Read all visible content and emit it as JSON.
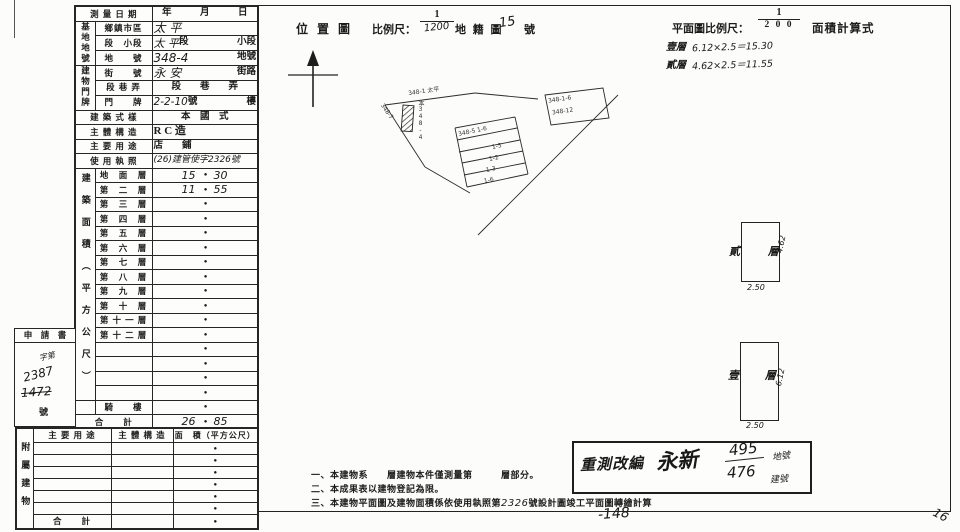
{
  "sheet": {
    "decimal_dot": "●"
  },
  "main_table": {
    "group_site": "基地地號",
    "group_door": "建物門牌",
    "group_area": "建築面積（平方公尺）",
    "survey_date": {
      "label": "測 量 日 期",
      "value": "年　　　月　　　日"
    },
    "district": {
      "label": "鄉鎮市區",
      "hw": "太 平"
    },
    "section": {
      "label": "段　小段",
      "hw": "太 平",
      "mid": "段",
      "suffix": "小段"
    },
    "lot": {
      "label": "地　　號",
      "hw": "348-4",
      "suffix": "地號"
    },
    "street": {
      "label": "街　　號",
      "hw": "永 安",
      "suffix": "街路"
    },
    "lane": {
      "label": "段 巷 弄",
      "value": "段　　巷　　弄"
    },
    "door": {
      "label": "門　　牌",
      "hw": "2-2-10",
      "mid": "號",
      "suffix": "樓"
    },
    "style": {
      "label": "建 築 式 樣",
      "value": "本　國　式"
    },
    "structure": {
      "label": "主 體 構 造",
      "value": "R C 造"
    },
    "usage": {
      "label": "主 要 用 途",
      "value": "店　　鋪"
    },
    "license": {
      "label": "使 用 執 照",
      "hw": "(26)建管使字2326號"
    },
    "floors": [
      {
        "label": "地　面　層",
        "int": "15",
        "dec": "30"
      },
      {
        "label": "第　二　層",
        "int": "11",
        "dec": "55"
      },
      {
        "label": "第　三　層",
        "int": "",
        "dec": ""
      },
      {
        "label": "第　四　層",
        "int": "",
        "dec": ""
      },
      {
        "label": "第　五　層",
        "int": "",
        "dec": ""
      },
      {
        "label": "第　六　層",
        "int": "",
        "dec": ""
      },
      {
        "label": "第　七　層",
        "int": "",
        "dec": ""
      },
      {
        "label": "第　八　層",
        "int": "",
        "dec": ""
      },
      {
        "label": "第　九　層",
        "int": "",
        "dec": ""
      },
      {
        "label": "第　十　層",
        "int": "",
        "dec": ""
      },
      {
        "label": "第 十 一 層",
        "int": "",
        "dec": ""
      },
      {
        "label": "第 十 二 層",
        "int": "",
        "dec": ""
      },
      {
        "label": "",
        "int": "",
        "dec": ""
      },
      {
        "label": "",
        "int": "",
        "dec": ""
      },
      {
        "label": "",
        "int": "",
        "dec": ""
      },
      {
        "label": "",
        "int": "",
        "dec": ""
      },
      {
        "label": "騎　　樓",
        "int": "",
        "dec": ""
      }
    ],
    "total": {
      "label": "合　　計",
      "int": "26",
      "dec": "85"
    }
  },
  "applicant_box": {
    "title": "申　請　書",
    "line1": "字第",
    "line2": "2387",
    "line3": "1472",
    "suffix": "號"
  },
  "annex_table": {
    "side": "附屬建物",
    "h1": "主 要 用 途",
    "h2": "主 體 構 造",
    "h3": "面　積（平方公尺）",
    "total": "合　　計"
  },
  "location_map": {
    "title": "位 置 圖",
    "scale_label": "比例尺：",
    "num": "1",
    "den": "1200",
    "cadastre": "地 籍 圖",
    "sheet": "15",
    "sheet_suffix": "號",
    "labels": [
      "348-1 太平",
      "348-7",
      "本348-4",
      "348-1-6",
      "348-12",
      "348-5 1-6",
      "1-5",
      "1-2",
      "1-3",
      "1-6"
    ]
  },
  "plan": {
    "scale_label": "平面圖比例尺：",
    "num": "1",
    "den": "2 0 0",
    "calc_title": "面積計算式",
    "calc1_floor": "壹層",
    "calc1": "6.12×2.5＝15.30",
    "calc2_floor": "貳層",
    "calc2": "4.62×2.5＝11.55",
    "floor2_label": "貳 層",
    "floor2_h": "4.62",
    "floor2_w": "2.50",
    "floor1_label": "壹 層",
    "floor1_h": "6.12",
    "floor1_w": "2.50"
  },
  "stamp": {
    "title": "重測改編",
    "section": "永新",
    "lot": "495",
    "lot_suffix": "地號",
    "bldg": "476",
    "bldg_suffix": "建號"
  },
  "notes": {
    "n1": "一、本建物系　　層建物本件僅測量第　　　層部分。",
    "n2": "二、本成果表以建物登記為限。",
    "n3a": "三、本建物平面圖及建物面積係依使用執照第",
    "n3hw": "2326",
    "n3b": "號設計圖竣工平面圖轉繪計算"
  },
  "marks": {
    "bottom": "-148",
    "corner": "16"
  }
}
